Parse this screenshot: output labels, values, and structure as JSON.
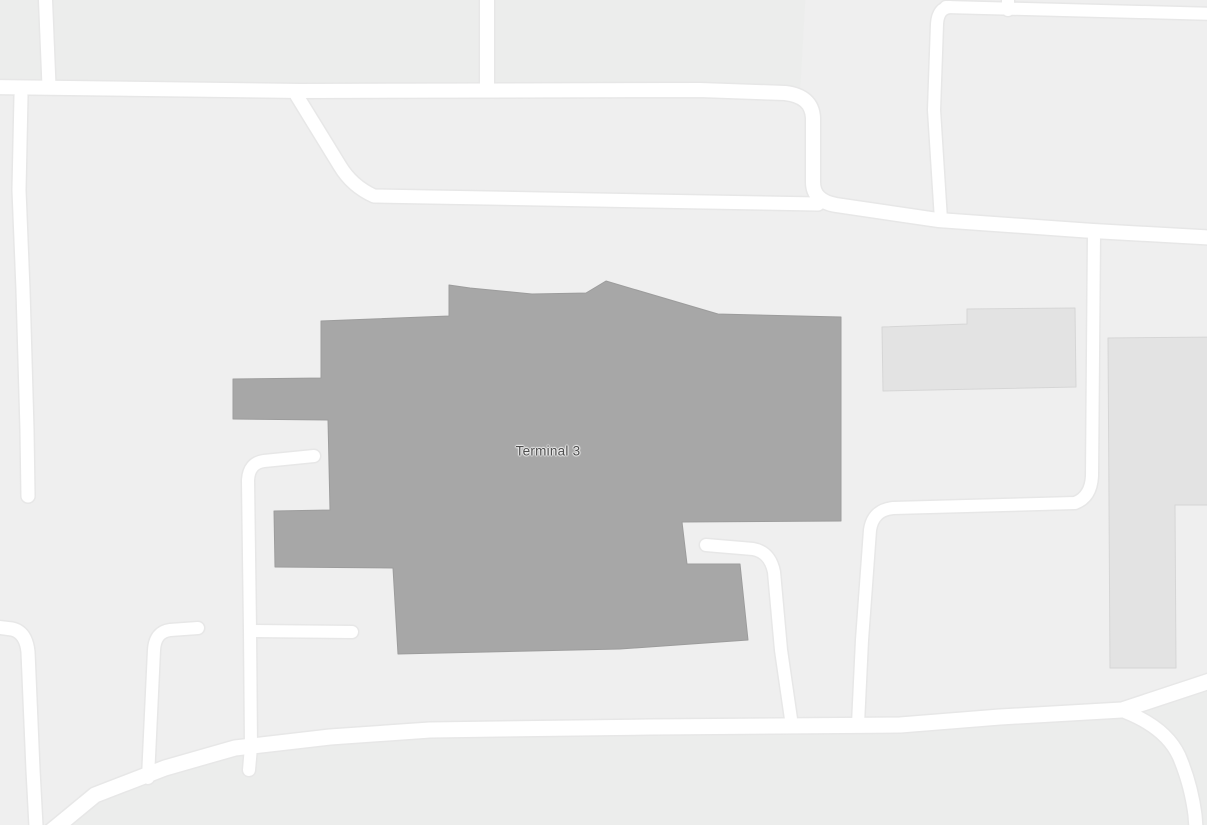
{
  "map": {
    "label": {
      "text": "Terminal 3",
      "x": 548,
      "y": 451,
      "color": "#4e4e4e"
    },
    "colors": {
      "background": "#efefef",
      "parcel_tint": "#ecedec",
      "road_fill": "#ffffff",
      "road_casing": "#e7e7e7",
      "terminal_fill": "#a7a7a7",
      "terminal_stroke": "#9c9c9c",
      "building_fill": "#e3e3e3",
      "building_stroke": "#d6d6d6"
    },
    "tints": [
      {
        "name": "parcel-north",
        "d": "M -12,-12 L 806,-12 L 800,94 L -12,88 Z"
      },
      {
        "name": "parcel-south",
        "d": "M 38,842 L 95,795 L 165,768 L 235,748 L 330,737 L 430,730 L 650,727 L 900,725 L 1000,717 L 1122,710 L 1219,678 L 1219,842 Z"
      }
    ],
    "buildings": [
      {
        "name": "terminal-3-building",
        "kind": "terminal",
        "d": "M 321,321 L 449,316 L 449,285 L 470,288 L 532,294 L 586,293 L 606,281 L 718,314 L 841,317 L 841,521 L 682,522 L 687,564 L 740,564 L 748,640 L 620,649 L 398,654 L 393,568 L 275,567 L 274,511 L 330,510 L 328,420 L 233,419 L 233,379 L 321,378 Z"
      },
      {
        "name": "building-northeast",
        "kind": "building",
        "d": "M 882,327 L 967,324 L 967,309 L 1075,308 L 1076,387 L 883,391 Z"
      },
      {
        "name": "building-east",
        "kind": "building",
        "d": "M 1108,338 L 1219,337 L 1219,505 L 1175,505 L 1176,668 L 1110,668 Z"
      }
    ],
    "roads": [
      {
        "name": "road-top-left-stub",
        "d": "M 45,-12 L 49,86",
        "w": 13
      },
      {
        "name": "road-main-west-east",
        "d": "M -12,87 L 300,91 L 700,90 L 785,93 Q 812,96 813,118 L 813,182 Q 813,201 836,205 L 938,220 L 1093,231 L 1219,238",
        "w": 14
      },
      {
        "name": "road-loop-inner",
        "d": "M 297,96 L 340,166 Q 352,186 374,196 L 818,204",
        "w": 13
      },
      {
        "name": "road-top-center-stub",
        "d": "M 487,-12 L 487,88",
        "w": 14
      },
      {
        "name": "road-west-vertical",
        "d": "M 21,96 L 19,190 L 23,290 L 27,430 L 28,496",
        "w": 13
      },
      {
        "name": "road-northeast-vertical",
        "d": "M 950,7 Q 938,8 937,24 L 934,110 L 941,220",
        "w": 12
      },
      {
        "name": "road-top-right",
        "d": "M 946,7 L 1219,14",
        "w": 12
      },
      {
        "name": "road-top-right-stub",
        "d": "M 1008,-12 L 1008,10",
        "w": 12
      },
      {
        "name": "road-east-vertical",
        "d": "M 1094,233 L 1092,476 Q 1091,497 1075,503 L 893,508 Q 873,510 870,530 L 862,640 L 858,724",
        "w": 12
      },
      {
        "name": "road-terminal-south",
        "d": "M 706,545 L 753,549 Q 770,552 774,572 L 781,650 L 792,726",
        "w": 12
      },
      {
        "name": "road-center-vertical",
        "d": "M 314,456 L 264,461 Q 249,463 248,480 L 250,630 L 251,747 L 249,770",
        "w": 12
      },
      {
        "name": "road-center-stub",
        "d": "M 253,631 L 352,632",
        "w": 12
      },
      {
        "name": "road-southwest-elbow",
        "d": "M 198,628 L 170,630 Q 155,632 154,650 L 148,778",
        "w": 12
      },
      {
        "name": "road-far-southwest",
        "d": "M -12,626 L 12,629 Q 26,632 28,652 L 33,770 L 37,845",
        "w": 13
      },
      {
        "name": "road-south-main",
        "d": "M 38,842 L 95,795 L 165,768 L 235,748 L 330,737 L 430,730 L 650,727 L 900,725 L 1000,717 L 1122,710 L 1219,678",
        "w": 15
      },
      {
        "name": "road-southeast-branch",
        "d": "M 1126,712 Q 1166,728 1179,756 Q 1191,784 1195,815 L 1197,842",
        "w": 13
      }
    ]
  }
}
